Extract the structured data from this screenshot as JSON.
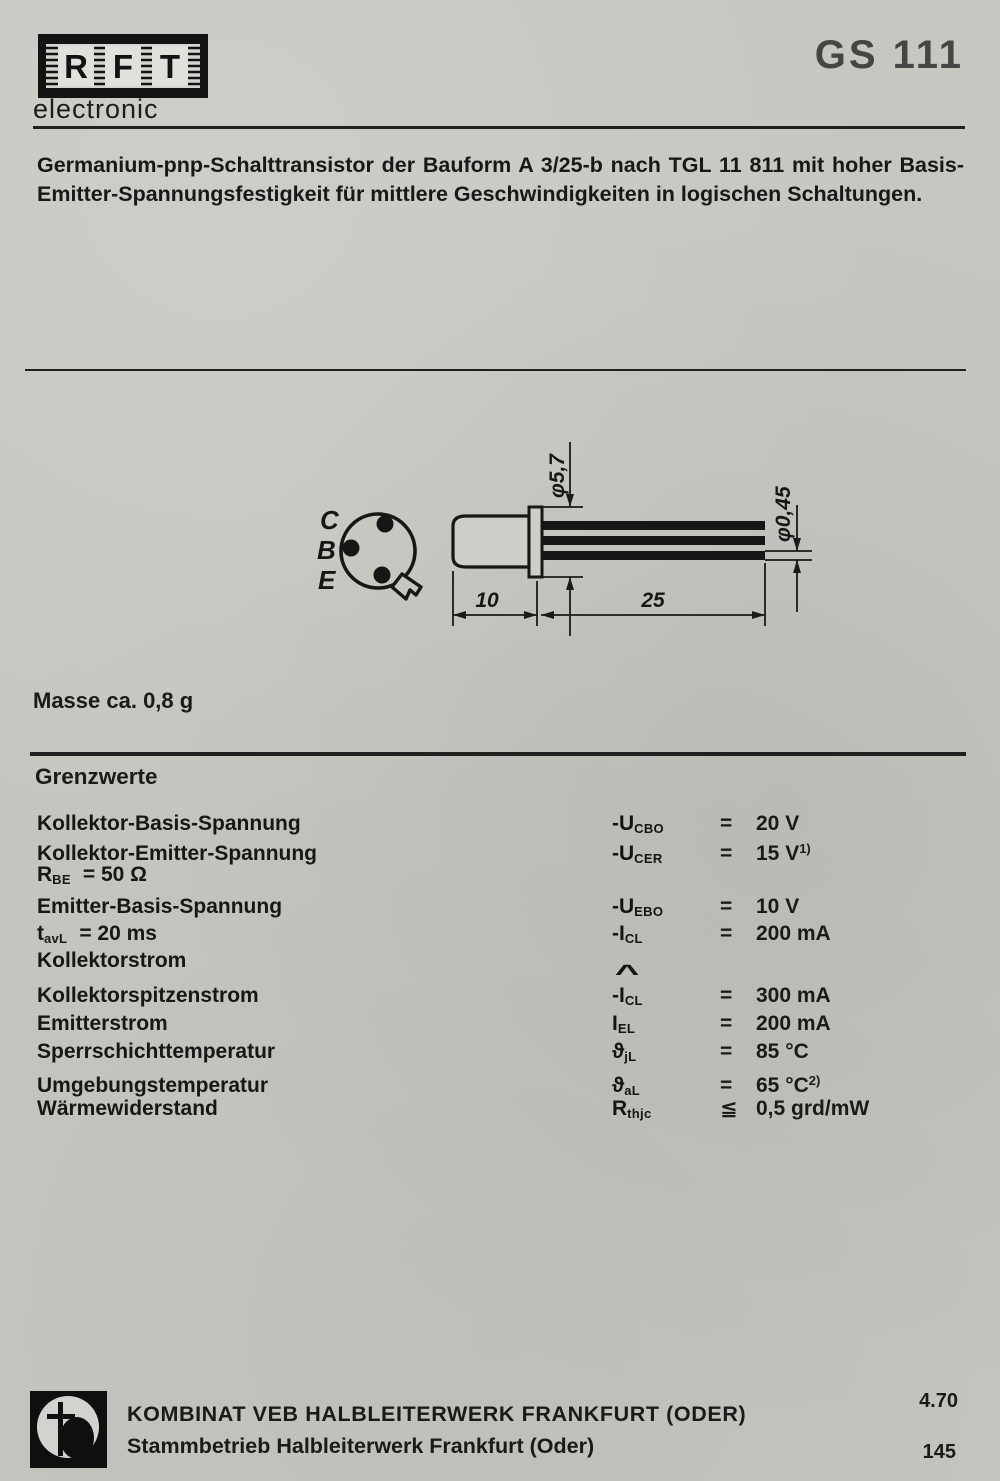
{
  "header": {
    "brand_letters": [
      "R",
      "F",
      "T"
    ],
    "brand_sub": "electronic",
    "model": "GS 111"
  },
  "intro": "Germanium-pnp-Schalttransistor der Bauform A 3/25-b nach TGL 11 811 mit hoher Basis-Emitter-Spannungsfestigkeit für mittlere Geschwindigkeiten in logischen Schaltungen.",
  "drawing": {
    "pins": [
      "C",
      "B",
      "E"
    ],
    "dim_flange_dia": "φ5,7",
    "dim_lead_dia": "φ0,45",
    "dim_body_len": "10",
    "dim_lead_len": "25"
  },
  "mass": "Masse ca. 0,8 g",
  "limits": {
    "title": "Grenzwerte",
    "rows": [
      {
        "label": "Kollektor-Basis-Spannung",
        "sym": "-U",
        "sub": "CBO",
        "rel": "=",
        "value": "20 V"
      },
      {
        "label": "Kollektor-Emitter-Spannung",
        "sym": "-U",
        "sub": "CER",
        "rel": "=",
        "value": "15 V",
        "note": "1)"
      },
      {
        "cond": "R",
        "cond_sub": "BE",
        "cond_rest": "=  50 Ω"
      },
      {
        "label": "Emitter-Basis-Spannung",
        "sym": "-U",
        "sub": "EBO",
        "rel": "=",
        "value": "10 V"
      },
      {
        "cond": "t",
        "cond_sub": "avL",
        "cond_rest": "=  20 ms",
        "sym": "-I",
        "sub": "CL",
        "rel": "=",
        "value": "200 mA"
      },
      {
        "label": "Kollektorstrom"
      },
      {
        "label": "Kollektorspitzenstrom",
        "hat": "^",
        "sym": "-I",
        "sub": "CL",
        "rel": "=",
        "value": "300 mA"
      },
      {
        "label": "Emitterstrom",
        "sym": "I",
        "sub": "EL",
        "rel": "=",
        "value": "200 mA"
      },
      {
        "label": "Sperrschichttemperatur",
        "sym": "ϑ",
        "sub": "jL",
        "rel": "=",
        "value": "85 °C"
      },
      {
        "label": "Umgebungstemperatur",
        "sym": "ϑ",
        "sub": "aL",
        "rel": "=",
        "value": "65 °C",
        "note": "2)"
      },
      {
        "label": "Wärmewiderstand",
        "sym": "R",
        "sub": "thjc",
        "rel": "≦",
        "value": "0,5 grd/mW"
      }
    ]
  },
  "footer": {
    "company_line1": "KOMBINAT VEB HALBLEITERWERK FRANKFURT (ODER)",
    "company_line2": "Stammbetrieb Halbleiterwerk Frankfurt (Oder)",
    "date_code": "4.70",
    "page_number": "145"
  },
  "colors": {
    "ink": "#1a1a1a",
    "paper": "#c8c6c1"
  }
}
